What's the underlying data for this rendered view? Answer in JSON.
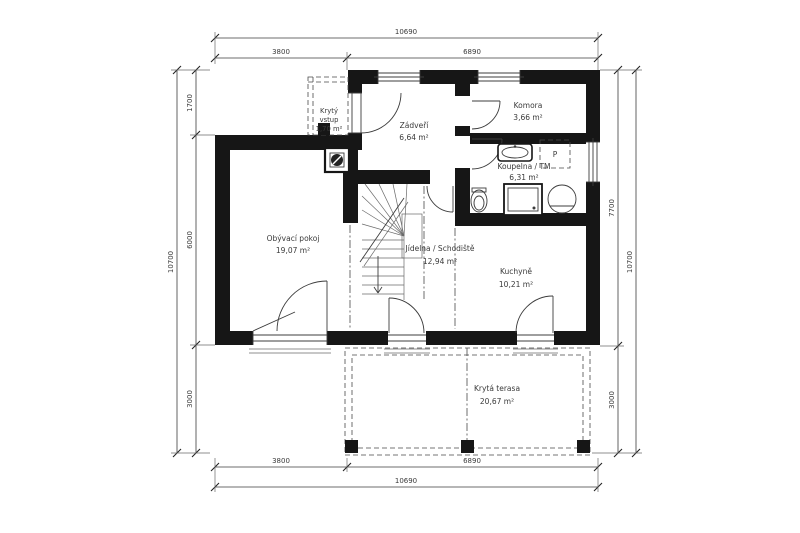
{
  "drawing": {
    "type": "floor-plan",
    "language": "cs",
    "colors": {
      "wall": "#161616",
      "line": "#3c3c3c",
      "text": "#3a3a3a",
      "background": "#ffffff"
    }
  },
  "rooms": {
    "kryty_vstup": {
      "name_line1": "Krytý",
      "name_line2": "vstup",
      "area": "1,70 m²"
    },
    "zadveri": {
      "name": "Zádveří",
      "area": "6,64 m²"
    },
    "komora": {
      "name": "Komora",
      "area": "3,66 m²"
    },
    "koupelna": {
      "name": "Koupelna / TM",
      "area": "6,31 m²"
    },
    "jidelna": {
      "name": "Jídelna / Schodiště",
      "area": "12,94 m²"
    },
    "kuchyne": {
      "name": "Kuchyně",
      "area": "10,21 m²"
    },
    "obyvaci": {
      "name": "Obývací pokoj",
      "area": "19,07 m²"
    },
    "terasa": {
      "name": "Krytá terasa",
      "area": "20,67 m²"
    }
  },
  "fixtures": {
    "washer_label": "P"
  },
  "dimensions": {
    "top": {
      "total": "10690",
      "left": "3800",
      "right": "6890"
    },
    "bottom": {
      "total": "10690",
      "left": "3800",
      "right": "6890"
    },
    "left": {
      "total": "10700",
      "segments": [
        "1700",
        "6000",
        "3000"
      ]
    },
    "right": {
      "total": "10700",
      "segments": [
        "7700",
        "3000"
      ]
    }
  }
}
